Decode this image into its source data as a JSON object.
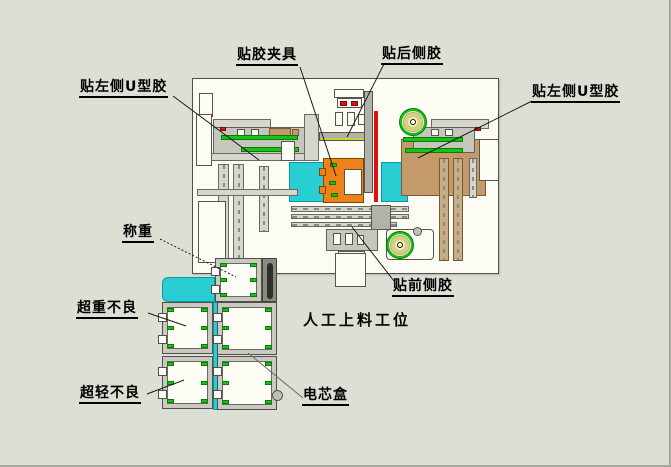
{
  "diagram": {
    "labels": {
      "taping_fixture": "贴胶夹具",
      "back_side_taping": "贴后侧胶",
      "left_u_taping_left": "贴左侧U型胶",
      "left_u_taping_right": "贴左侧U型胶",
      "weighing": "称重",
      "overweight_reject": "超重不良",
      "underweight_reject": "超轻不良",
      "front_side_taping": "贴前侧胶",
      "manual_loading_station": "人工上料工位",
      "cell_box": "电芯盒"
    },
    "colors": {
      "background": "#dedfd4",
      "frame_fill": "#fcfcf5",
      "conveyor_cyan": "#29ced2",
      "fixture_orange": "#ee8118",
      "highlight_green": "#14c314",
      "marker_red": "#e01010",
      "plate_tan": "#c49a6a",
      "tape_coil_khaki": "#d2cf88"
    }
  }
}
